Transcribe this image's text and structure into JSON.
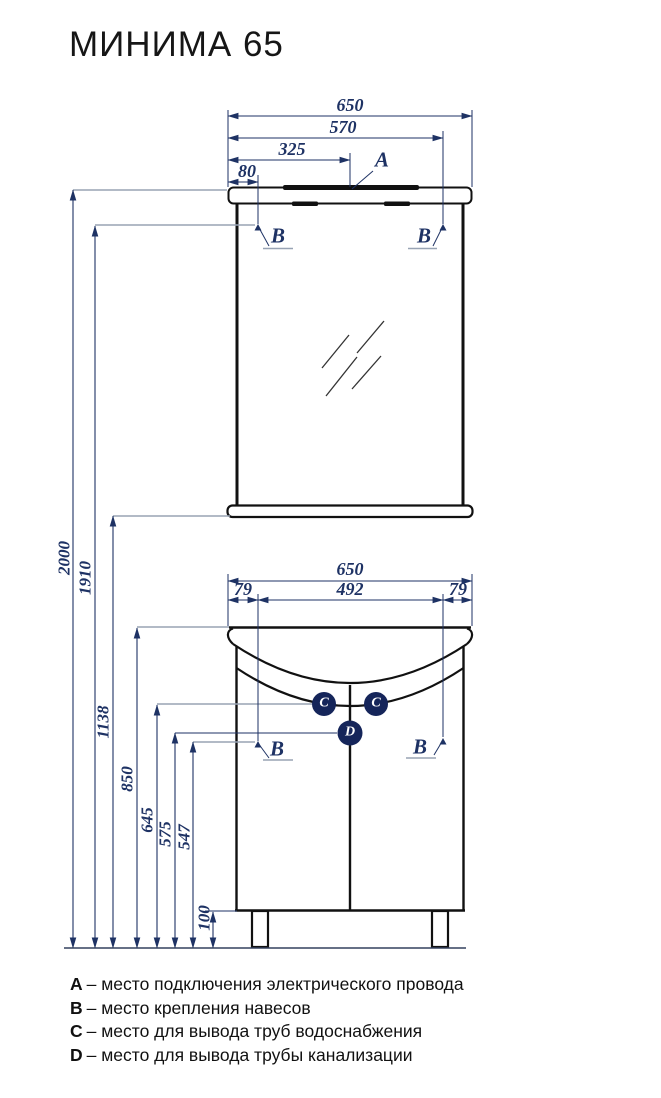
{
  "title": "МИНИМА 65",
  "drawing": {
    "mirror_unit": {
      "dim_650": "650",
      "dim_570": "570",
      "dim_325": "325",
      "dim_80": "80",
      "marker_a": "A",
      "marker_b_left": "B",
      "marker_b_right": "B"
    },
    "vanity_unit": {
      "dim_650": "650",
      "dim_79_left": "79",
      "dim_492": "492",
      "dim_79_right": "79",
      "marker_c_left": "C",
      "marker_c_right": "C",
      "marker_d": "D",
      "marker_b_left": "B",
      "marker_b_right": "B"
    },
    "heights": {
      "h_2000": "2000",
      "h_1910": "1910",
      "h_1138": "1138",
      "h_850": "850",
      "h_645": "645",
      "h_575": "575",
      "h_547": "547",
      "h_100": "100"
    }
  },
  "legend": {
    "items": [
      {
        "key": "A",
        "text": "– место подключения электрического провода"
      },
      {
        "key": "B",
        "text": "– место крепления навесов"
      },
      {
        "key": "C",
        "text": "– место для вывода труб водоснабжения"
      },
      {
        "key": "D",
        "text": "– место для вывода трубы канализации"
      }
    ]
  },
  "colors": {
    "outline": "#111111",
    "dimension": "#1E3264",
    "leader": "#98A3B4",
    "marker_fill": "#15255A"
  }
}
